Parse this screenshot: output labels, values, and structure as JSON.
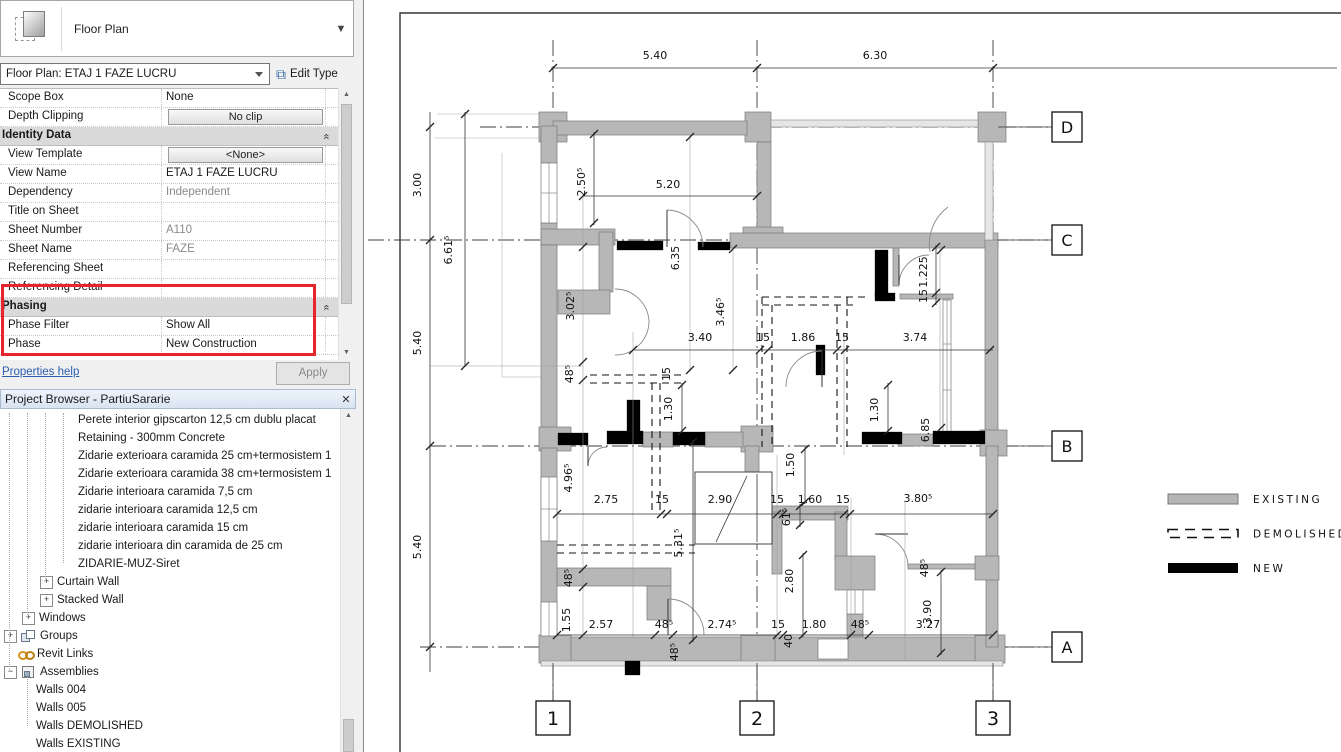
{
  "properties_panel": {
    "type_selector_label": "Floor Plan",
    "instance_selector": "Floor Plan: ETAJ 1 FAZE LUCRU",
    "edit_type_label": "Edit Type",
    "rows": [
      {
        "label": "Scope Box",
        "value": "None",
        "kind": "text"
      },
      {
        "label": "Depth Clipping",
        "value": "No clip",
        "kind": "button"
      },
      {
        "label": "Identity Data",
        "kind": "section"
      },
      {
        "label": "View Template",
        "value": "<None>",
        "kind": "button"
      },
      {
        "label": "View Name",
        "value": "ETAJ 1 FAZE LUCRU",
        "kind": "text"
      },
      {
        "label": "Dependency",
        "value": "Independent",
        "kind": "muted"
      },
      {
        "label": "Title on Sheet",
        "value": "",
        "kind": "text"
      },
      {
        "label": "Sheet Number",
        "value": "A110",
        "kind": "muted"
      },
      {
        "label": "Sheet Name",
        "value": "FAZE",
        "kind": "muted"
      },
      {
        "label": "Referencing Sheet",
        "value": "",
        "kind": "muted"
      },
      {
        "label": "Referencing Detail",
        "value": "",
        "kind": "muted"
      },
      {
        "label": "Phasing",
        "kind": "section"
      },
      {
        "label": "Phase Filter",
        "value": "Show All",
        "kind": "text"
      },
      {
        "label": "Phase",
        "value": "New Construction",
        "kind": "text"
      }
    ],
    "properties_help": "Properties help",
    "apply_label": "Apply",
    "highlight_color": "#e8252a"
  },
  "project_browser": {
    "title": "Project Browser - PartiuSararie",
    "close_icon": "✕",
    "items": [
      {
        "label": "Perete interior gipscarton 12,5 cm dublu placat",
        "level": 4,
        "expand": null,
        "icon": null
      },
      {
        "label": "Retaining - 300mm Concrete",
        "level": 4,
        "expand": null,
        "icon": null
      },
      {
        "label": "Zidarie exterioara caramida 25 cm+termosistem 1",
        "level": 4,
        "expand": null,
        "icon": null
      },
      {
        "label": "Zidarie exterioara caramida 38 cm+termosistem 1",
        "level": 4,
        "expand": null,
        "icon": null
      },
      {
        "label": "Zidarie interioara caramida 7,5 cm",
        "level": 4,
        "expand": null,
        "icon": null
      },
      {
        "label": "zidarie interioara caramida 12,5 cm",
        "level": 4,
        "expand": null,
        "icon": null
      },
      {
        "label": "zidarie interioara caramida 15 cm",
        "level": 4,
        "expand": null,
        "icon": null
      },
      {
        "label": "zidarie interioara din caramida de 25 cm",
        "level": 4,
        "expand": null,
        "icon": null
      },
      {
        "label": "ZIDARIE-MUZ-Siret",
        "level": 4,
        "expand": null,
        "icon": null
      },
      {
        "label": "Curtain Wall",
        "level": 3,
        "expand": "+",
        "icon": null
      },
      {
        "label": "Stacked Wall",
        "level": 3,
        "expand": "+",
        "icon": null
      },
      {
        "label": "Windows",
        "level": 2,
        "expand": "+",
        "icon": null
      },
      {
        "label": "Groups",
        "level": 1,
        "expand": "+",
        "icon": "groups"
      },
      {
        "label": "Revit Links",
        "level": 1,
        "expand": null,
        "icon": "link"
      },
      {
        "label": "Assemblies",
        "level": 1,
        "expand": "−",
        "icon": "assembly"
      },
      {
        "label": "Walls 004",
        "level": 2,
        "expand": null,
        "icon": null
      },
      {
        "label": "Walls 005",
        "level": 2,
        "expand": null,
        "icon": null
      },
      {
        "label": "Walls DEMOLISHED",
        "level": 2,
        "expand": null,
        "icon": null
      },
      {
        "label": "Walls EXISTING",
        "level": 2,
        "expand": null,
        "icon": null
      }
    ]
  },
  "plan": {
    "grid_bubbles": [
      {
        "label": "D",
        "x": 1067,
        "y": 127,
        "size": 30
      },
      {
        "label": "C",
        "x": 1067,
        "y": 240,
        "size": 30
      },
      {
        "label": "B",
        "x": 1067,
        "y": 446,
        "size": 30
      },
      {
        "label": "A",
        "x": 1067,
        "y": 647,
        "size": 30
      },
      {
        "label": "1",
        "x": 553,
        "y": 718,
        "size": 34
      },
      {
        "label": "2",
        "x": 757,
        "y": 718,
        "size": 34
      },
      {
        "label": "3",
        "x": 993,
        "y": 718,
        "size": 34
      }
    ],
    "dimensions": [
      {
        "t": "5.40",
        "x": 655,
        "y": 59,
        "r": 0
      },
      {
        "t": "6.30",
        "x": 875,
        "y": 59,
        "r": 0
      },
      {
        "t": "3.00",
        "x": 421,
        "y": 185,
        "r": -90
      },
      {
        "t": "5.40",
        "x": 421,
        "y": 343,
        "r": -90
      },
      {
        "t": "5.40",
        "x": 421,
        "y": 547,
        "r": -90
      },
      {
        "t": "6.61⁵",
        "x": 452,
        "y": 250,
        "r": -90
      },
      {
        "t": "2.50⁵",
        "x": 585,
        "y": 182,
        "r": -90
      },
      {
        "t": "5.20",
        "x": 668,
        "y": 188,
        "r": 0
      },
      {
        "t": "6.35",
        "x": 679,
        "y": 258,
        "r": -90
      },
      {
        "t": "3.02⁵",
        "x": 574,
        "y": 306,
        "r": -90
      },
      {
        "t": "3.46⁵",
        "x": 724,
        "y": 312,
        "r": -90
      },
      {
        "t": "48⁵",
        "x": 573,
        "y": 374,
        "r": -90
      },
      {
        "t": "3.40",
        "x": 700,
        "y": 341,
        "r": 0
      },
      {
        "t": "15",
        "x": 763,
        "y": 341,
        "r": 0
      },
      {
        "t": "1.86",
        "x": 803,
        "y": 341,
        "r": 0
      },
      {
        "t": "15",
        "x": 842,
        "y": 341,
        "r": 0
      },
      {
        "t": "3.74",
        "x": 915,
        "y": 341,
        "r": 0
      },
      {
        "t": "1.225",
        "x": 927,
        "y": 272,
        "r": -90
      },
      {
        "t": "15",
        "x": 927,
        "y": 296,
        "r": -90
      },
      {
        "t": "6.85",
        "x": 929,
        "y": 430,
        "r": -90
      },
      {
        "t": "15",
        "x": 670,
        "y": 374,
        "r": -90
      },
      {
        "t": "1.30",
        "x": 672,
        "y": 409,
        "r": -90
      },
      {
        "t": "1.30",
        "x": 878,
        "y": 410,
        "r": -90
      },
      {
        "t": "4.96⁵",
        "x": 572,
        "y": 478,
        "r": -90
      },
      {
        "t": "2.75",
        "x": 606,
        "y": 503,
        "r": 0
      },
      {
        "t": "15",
        "x": 662,
        "y": 503,
        "r": 0
      },
      {
        "t": "2.90",
        "x": 720,
        "y": 503,
        "r": 0
      },
      {
        "t": "15",
        "x": 777,
        "y": 503,
        "r": 0
      },
      {
        "t": "1.60",
        "x": 810,
        "y": 503,
        "r": 0
      },
      {
        "t": "15",
        "x": 843,
        "y": 503,
        "r": 0
      },
      {
        "t": "3.80⁵",
        "x": 918,
        "y": 502,
        "r": 0
      },
      {
        "t": "1.50",
        "x": 794,
        "y": 465,
        "r": -90
      },
      {
        "t": "61⁵",
        "x": 790,
        "y": 517,
        "r": -90
      },
      {
        "t": "5.31⁵",
        "x": 682,
        "y": 543,
        "r": -90
      },
      {
        "t": "2.80",
        "x": 793,
        "y": 581,
        "r": -90
      },
      {
        "t": "40",
        "x": 792,
        "y": 641,
        "r": -90
      },
      {
        "t": "48⁵",
        "x": 572,
        "y": 578,
        "r": -90
      },
      {
        "t": "1.55",
        "x": 570,
        "y": 620,
        "r": -90
      },
      {
        "t": "2.57",
        "x": 601,
        "y": 628,
        "r": 0
      },
      {
        "t": "48⁵",
        "x": 664,
        "y": 628,
        "r": 0
      },
      {
        "t": "2.74⁵",
        "x": 722,
        "y": 628,
        "r": 0
      },
      {
        "t": "15",
        "x": 778,
        "y": 628,
        "r": 0
      },
      {
        "t": "1.80",
        "x": 814,
        "y": 628,
        "r": 0
      },
      {
        "t": "48⁵",
        "x": 860,
        "y": 628,
        "r": 0
      },
      {
        "t": "3.27",
        "x": 928,
        "y": 628,
        "r": 0
      },
      {
        "t": "48⁵",
        "x": 678,
        "y": 652,
        "r": -90
      },
      {
        "t": "48⁵",
        "x": 928,
        "y": 568,
        "r": -90
      },
      {
        "t": "3.90",
        "x": 931,
        "y": 612,
        "r": -90
      }
    ],
    "legend": [
      {
        "label": "EXISTING",
        "style": "existing",
        "color": "#b5b5b5"
      },
      {
        "label": "DEMOLISHED",
        "style": "demolished",
        "color": "#111111"
      },
      {
        "label": "NEW",
        "style": "new",
        "color": "#000000"
      }
    ]
  }
}
